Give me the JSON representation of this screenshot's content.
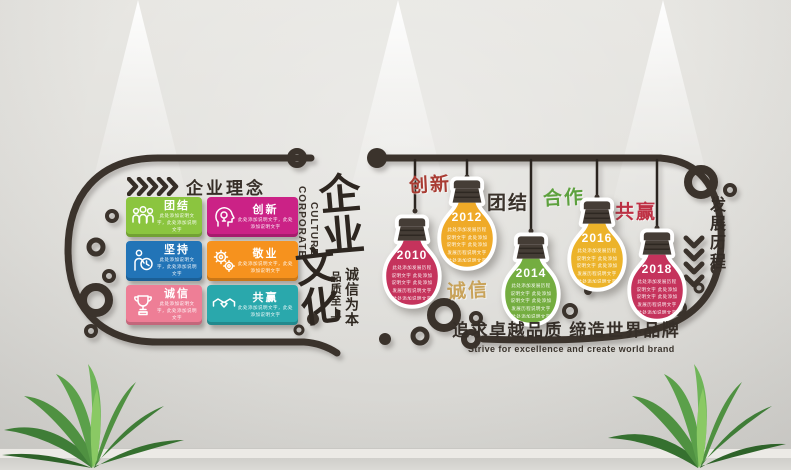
{
  "philosophy": {
    "heading": "企业理念",
    "cards": [
      {
        "title": "团结",
        "icon": "people-icon",
        "color": "#8bc53f",
        "body": "此处添加说明文字，此处添加说明文字"
      },
      {
        "title": "创新",
        "icon": "idea-head-icon",
        "color": "#cb2286",
        "body": "此处添加说明文字，此处添加说明文字"
      },
      {
        "title": "坚持",
        "icon": "person-clock-icon",
        "color": "#2274b7",
        "body": "此处添加说明文字，此处添加说明文字"
      },
      {
        "title": "敬业",
        "icon": "gears-icon",
        "color": "#f6921e",
        "body": "此处添加说明文字，此处添加说明文字"
      },
      {
        "title": "诚信",
        "icon": "trophy-icon",
        "color": "#ee7e96",
        "body": "此处添加说明文字，此处添加说明文字"
      },
      {
        "title": "共赢",
        "icon": "handshake-icon",
        "color": "#2aa8ac",
        "body": "此处添加说明文字，此处添加说明文字"
      }
    ]
  },
  "center": {
    "vertical_en_1": "CORPORATE",
    "vertical_en_2": "CULTURE",
    "calligraphy_top": "企业",
    "calligraphy_bottom": "文化",
    "motto_primary": "诚信为本",
    "motto_secondary": "品质至上"
  },
  "timeline": {
    "heading": "发展历程",
    "milestones": [
      {
        "year": "2010",
        "color": "#c5335c",
        "body": "此处添加发展历程说明文字 此处添加说明文字 此处添加发展历程说明文字 此处添加说明文字"
      },
      {
        "year": "2012",
        "color": "#efaa28",
        "body": "此处添加发展历程说明文字 此处添加说明文字 此处添加发展历程说明文字 此处添加说明文字"
      },
      {
        "year": "2014",
        "color": "#74ad40",
        "body": "此处添加发展历程说明文字 此处添加说明文字 此处添加发展历程说明文字 此处添加说明文字"
      },
      {
        "year": "2016",
        "color": "#ecb32a",
        "body": "此处添加发展历程说明文字 此处添加说明文字 此处添加发展历程说明文字 此处添加说明文字"
      },
      {
        "year": "2018",
        "color": "#c5335c",
        "body": "此处添加发展历程说明文字 此处添加说明文字 此处添加发展历程说明文字 此处添加说明文字"
      }
    ],
    "words": [
      {
        "text": "创新",
        "color": "#a93c33"
      },
      {
        "text": "团结",
        "color": "#3a322b"
      },
      {
        "text": "合作",
        "color": "#5da13e"
      },
      {
        "text": "共赢",
        "color": "#bf3145"
      },
      {
        "text": "诚信",
        "color": "#c9a35a"
      }
    ]
  },
  "slogan": {
    "cn": "追求卓越品质 缔造世界品牌",
    "en": "Strive for excellence and create world brand"
  },
  "palette": {
    "structure": "#3b332c",
    "wall": "#dfdeda",
    "bulb_cap": "#453d36"
  }
}
